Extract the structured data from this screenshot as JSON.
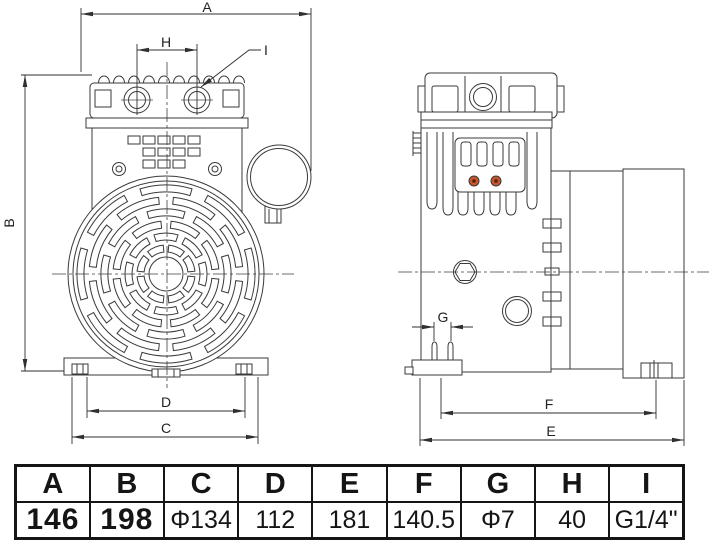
{
  "drawing": {
    "dims": {
      "A": "A",
      "B": "B",
      "C": "C",
      "D": "D",
      "E": "E",
      "F": "F",
      "G": "G",
      "H": "H",
      "I": "I"
    },
    "colors": {
      "line": "#3a3a3a",
      "screw_dot": "#c8562b",
      "screw_dot_center": "#55200f"
    }
  },
  "table": {
    "columns": [
      {
        "header": "A",
        "value": "146"
      },
      {
        "header": "B",
        "value": "198"
      },
      {
        "header": "C",
        "value": "Φ134"
      },
      {
        "header": "D",
        "value": "112"
      },
      {
        "header": "E",
        "value": "181"
      },
      {
        "header": "F",
        "value": "140.5"
      },
      {
        "header": "G",
        "value": "Φ7"
      },
      {
        "header": "H",
        "value": "40"
      },
      {
        "header": "I",
        "value": "G1/4\""
      }
    ]
  }
}
